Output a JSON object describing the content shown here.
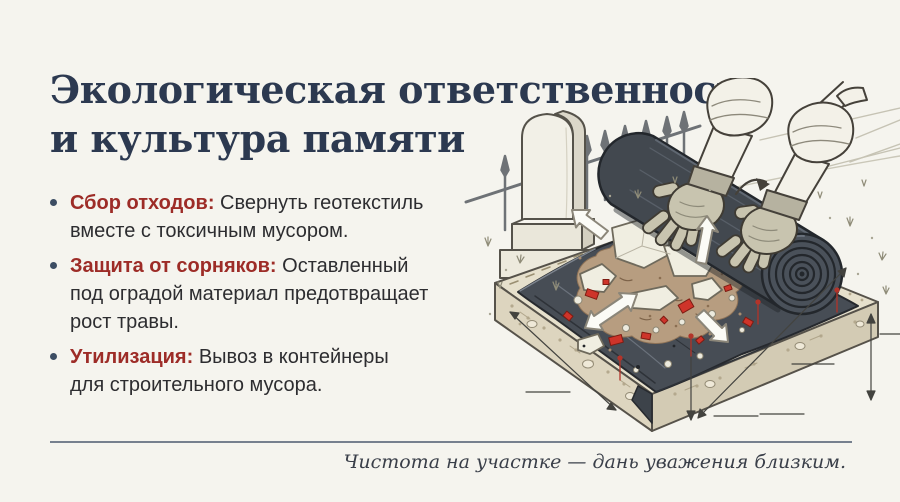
{
  "title": {
    "line1": "Экологическая ответственность",
    "line2": "и культура памяти"
  },
  "bullets": {
    "items": [
      {
        "label": "Сбор отходов:",
        "text": "Свернуть геотекстиль\nвместе с токсичным мусором."
      },
      {
        "label": "Защита от сорняков:",
        "text": "Оставленный\nпод оградой материал предотвращает\nрост травы."
      },
      {
        "label": "Утилизация:",
        "text": "Вывоз в контейнеры\nдля строительного мусора."
      }
    ]
  },
  "footer": {
    "quote": "Чистота на участке — дань уважения близким."
  },
  "colors": {
    "background": "#f5f4ee",
    "title": "#2c3950",
    "accent_red": "#9d2c27",
    "body_text": "#2d2d30",
    "bullet_dot": "#3c4d63",
    "rule": "#76808e",
    "quote": "#3a3f49",
    "geotextile": "#474d55",
    "soil": "#e6e0cc",
    "stone": "#f2f0e7",
    "glove": "#c8c4af",
    "debris_red": "#ce342a"
  }
}
